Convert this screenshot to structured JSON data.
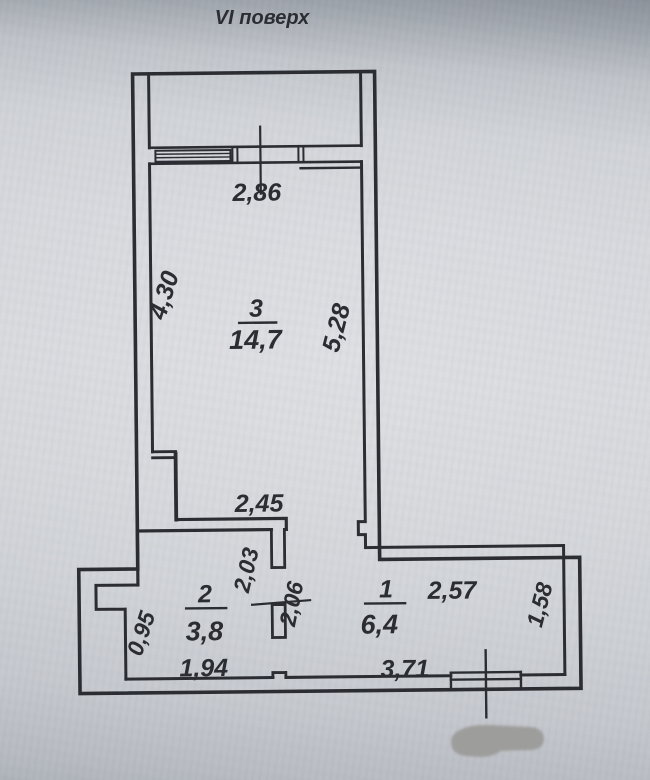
{
  "title": "VI поверх",
  "rooms": [
    {
      "number": "3",
      "area": "14,7"
    },
    {
      "number": "2",
      "area": "3,8"
    },
    {
      "number": "1",
      "area": "6,4"
    }
  ],
  "dimensions": {
    "room3_width_top": "2,86",
    "room3_left": "4,30",
    "room3_right": "5,28",
    "room3_bottom_wall": "2,45",
    "partition_left": "2,03",
    "partition_right": "2,06",
    "room1_top": "2,57",
    "room1_right": "1,58",
    "room2_left_niche": "0,95",
    "room2_bottom": "1,94",
    "room1_bottom": "3,71"
  },
  "colors": {
    "ink": "#2b2d33",
    "paper": "#d4d5da",
    "redaction": "#9a9a98"
  }
}
